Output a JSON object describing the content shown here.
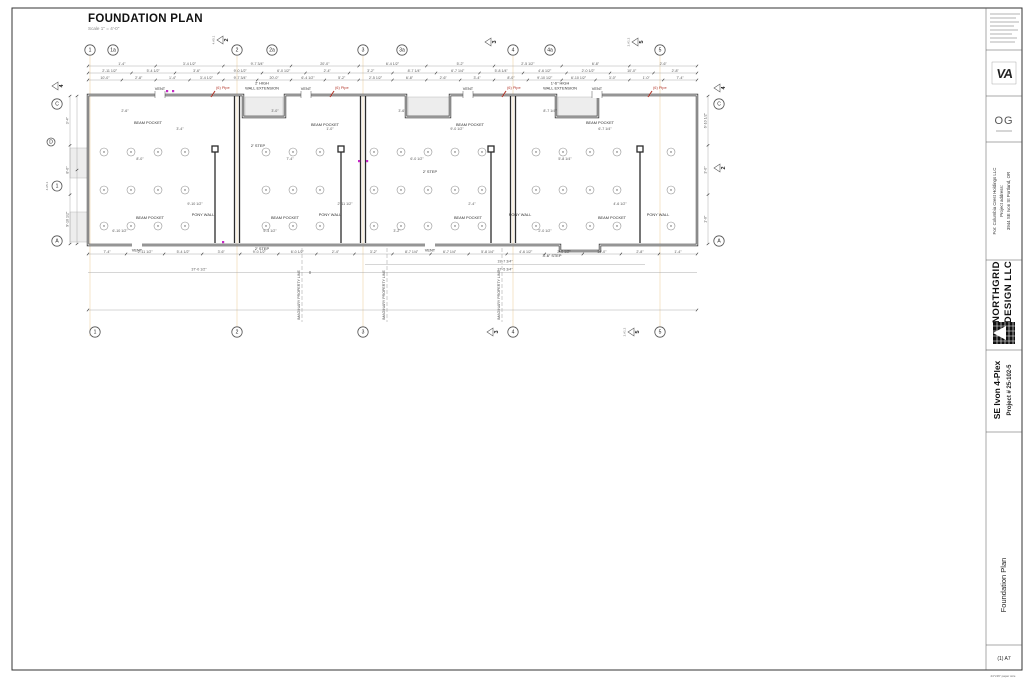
{
  "sheet": {
    "paper_note": "24\"x36\" paper size",
    "sheet_number": "(1) A7"
  },
  "title_block": {
    "logo_va": "VA",
    "logo_og": "OG",
    "client_line1": "For: Columbia Crest Holdings LLC",
    "client_line2": "Project address:",
    "client_line3": "3944 SE Ivon St Portland, OR",
    "firm_line1": "NORTHGRID",
    "firm_line2": "DESIGN LLC",
    "project_name": "SE Ivon 4-Plex",
    "project_number": "Project # 25-102-5",
    "sheet_title": "Foundation Plan"
  },
  "foundation_plan": {
    "title": "FOUNDATION PLAN",
    "scale": "Scale 1\" = 4'-0\"",
    "grids_top": [
      "1",
      "1a",
      "2",
      "2a",
      "3",
      "3a",
      "4",
      "4a",
      "5"
    ],
    "grids_bottom": [
      "1",
      "2",
      "3",
      "4",
      "5"
    ],
    "grids_left": [
      "C",
      "D",
      "A"
    ],
    "grids_right": [
      "C",
      "A"
    ],
    "labels": {
      "vent": "VENT",
      "pipe": "(6) Pipe",
      "beam_pocket": "BEAM POCKET",
      "pony_wall": "PONY WALL",
      "step_2": "2' STEP",
      "step_3_6": "3'-6\" STEP",
      "ext2_l1": "2' HIGH",
      "ext_l2": "WALL EXTENSION",
      "ext16_l1": "1'-6\" HIGH",
      "property": "IMAGINARY PROPERTY LINE"
    },
    "fan_note": [
      "454 sq ft / 50 cfm = 8.7 cfm",
      "PROVIDE FAN VENT",
      "AT EACH UNIT (~MIN. 10 CFM",
      "CONTINUOUSLY OPERATED)"
    ],
    "dim_19": "19'-7 3/4\"",
    "dim_37a": "37'-5 3/4\"",
    "dim_37b": "37'-0 1/2\"",
    "dims_misc": [
      "2'-6\"",
      "3'-4\"",
      "8'-0\"",
      "9'-10 1/2\"",
      "6'-10 1/2\"",
      "3'-0\"",
      "1'-0\"",
      "7'-4\"",
      "2'-11 1/2\"",
      "5'-4 1/2\"",
      "3'-6\"",
      "9'-0 1/2\"",
      "6'-0 1/2\"",
      "2'-4\"",
      "3'-2\"",
      "8'-7 1/4\"",
      "6'-7 1/4\"",
      "5'-8 1/4\"",
      "4'-6 1/2\"",
      "2'-0 1/2\"",
      "10'-0\"",
      "2'-8\"",
      "1'-4\"",
      "3'-4 1/2\"",
      "9'-7 3/4\"",
      "20'-0\"",
      "6'-4 1/2\"",
      "5'-2\"",
      "2'-5 1/2\"",
      "6'-8\""
    ]
  },
  "section_markers": {
    "m1": "1",
    "m2": "2",
    "m3": "3",
    "m4": "4",
    "m5": "5",
    "tagA": "4.A5.1",
    "tagB": "2.A1.2"
  },
  "typical_foundation": {
    "bubble": "A",
    "title": "Typical Foundation",
    "scale": "Scale 1\" = 1'",
    "note_title": "NOTE:",
    "note_line1": "412 SF / 50 CFM = 8.3 CFM MIN PROVIDE FAN VENT",
    "note_line2": "AT EACH UNIT (~MIN. 10 CFM CONTINUOUSLY OPERATED)",
    "refer_box": [
      "REFER TO THE (S)",
      "SHEETS FOR ALL",
      "STRUCTURAL",
      "INFORMATION"
    ]
  },
  "elevation_a": {
    "title": "FOUNDATION WALL ELEVATION ALONG GRID A",
    "grids": [
      "1",
      "2",
      "3",
      "4",
      "5"
    ]
  },
  "elevation_c": {
    "title": "FOUNDATION WALL ELEVATION ALONG GRID C",
    "grids": [
      "5",
      "4",
      "3",
      "2",
      "1"
    ]
  },
  "section": {
    "title": "SECTION A-A",
    "grids": [
      "1",
      "2",
      "3",
      "4",
      "5"
    ],
    "labels": {
      "pony": "PONY WALL",
      "ffe": "0' - F.F.E.",
      "neg": "-2 5/8\"",
      "d1": "1'-9 3/8\"",
      "d2": "2'-4 3/8\"",
      "d3": "2'-3 3/8\""
    }
  },
  "general_views": {
    "view1": "GENERAL VIEW 1",
    "view2": "GENERAL VIEW 2"
  }
}
